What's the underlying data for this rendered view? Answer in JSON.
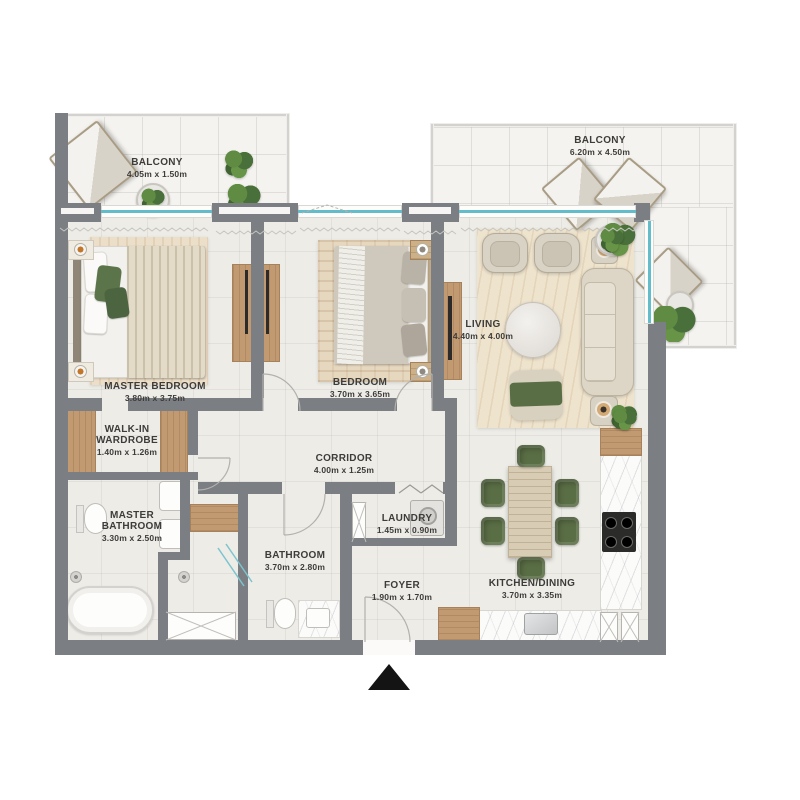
{
  "floorplan": {
    "rooms": {
      "balcony_left": {
        "name": "BALCONY",
        "dims": "4.05m x 1.50m"
      },
      "balcony_right": {
        "name": "BALCONY",
        "dims": "6.20m x 4.50m"
      },
      "master_bedroom": {
        "name": "MASTER BEDROOM",
        "dims": "3.80m x 3.75m"
      },
      "bedroom": {
        "name": "BEDROOM",
        "dims": "3.70m x 3.65m"
      },
      "living": {
        "name": "LIVING",
        "dims": "4.40m x 4.00m"
      },
      "walk_in_wardrobe": {
        "name": "WALK-IN\nWARDROBE",
        "dims": "1.40m x 1.26m"
      },
      "master_bathroom": {
        "name": "MASTER\nBATHROOM",
        "dims": "3.30m x 2.50m"
      },
      "corridor": {
        "name": "CORRIDOR",
        "dims": "4.00m x 1.25m"
      },
      "bathroom": {
        "name": "BATHROOM",
        "dims": "3.70m x 2.80m"
      },
      "laundry": {
        "name": "LAUNDRY",
        "dims": "1.45m x 0.90m"
      },
      "foyer": {
        "name": "FOYER",
        "dims": "1.90m x 1.70m"
      },
      "kitchen_dining": {
        "name": "KITCHEN/DINING",
        "dims": "3.70m x 3.35m"
      }
    },
    "colors": {
      "wall": "#7b7e82",
      "floor": "#edece7",
      "balcony_floor": "#f4f3ef",
      "wood": "#c29a72",
      "window_accent": "#62bcca",
      "plant_green": "#5d8047",
      "furniture_green": "#5a6e45",
      "rug": "#ecdfc9",
      "marble": "#fbfbfa",
      "label_text": "#3d3c3a",
      "entrance_marker": "#141414"
    }
  }
}
